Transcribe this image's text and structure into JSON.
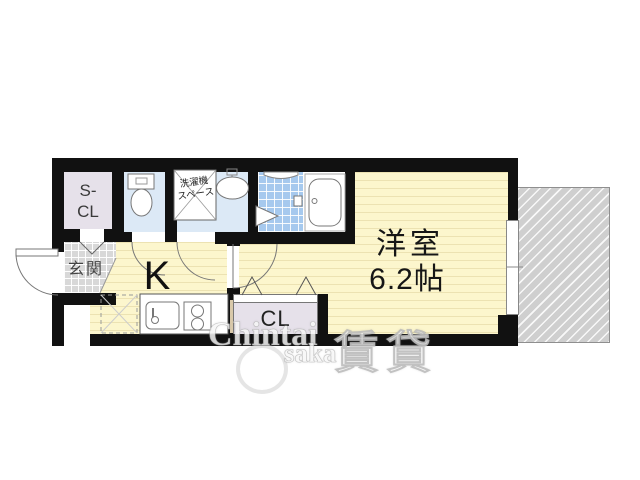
{
  "title": "1K apartment floor plan",
  "rooms": {
    "storage": {
      "line1": "S-",
      "line2": "CL"
    },
    "entrance": {
      "label": "玄関"
    },
    "kitchen": {
      "label": "K"
    },
    "laundry": {
      "line1": "洗濯機",
      "line2": "スペース"
    },
    "western": {
      "label": "洋室",
      "size": "6.2帖"
    },
    "closet": {
      "label": "CL"
    }
  },
  "watermark": {
    "brand": "Chintai",
    "brand_suffix": "saka",
    "kanji": "賃貸"
  },
  "colors": {
    "wall": "#111111",
    "tatami_floor": "#fcf6cd",
    "tatami_stripe": "#ece2b2",
    "wet_room": "#dce9f6",
    "closet_fill": "#e6e1ea",
    "bath_tile": "#a6c9ee",
    "entrance_tile": "#d8d8d8",
    "balcony": "#cfcfcf"
  }
}
